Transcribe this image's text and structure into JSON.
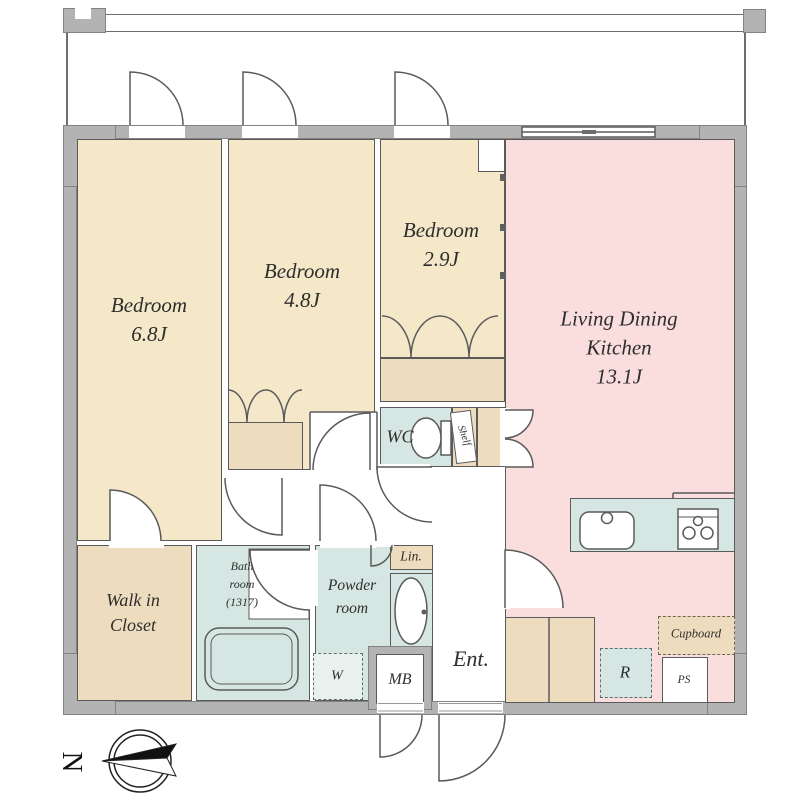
{
  "plan": {
    "bedroom1": {
      "name": "Bedroom",
      "area": "6.8J"
    },
    "bedroom2": {
      "name": "Bedroom",
      "area": "4.8J"
    },
    "bedroom3": {
      "name": "Bedroom",
      "area": "2.9J"
    },
    "ldk": {
      "name_line1": "Living Dining",
      "name_line2": "Kitchen",
      "area": "13.1J"
    },
    "wic": {
      "name_line1": "Walk in",
      "name_line2": "Closet"
    },
    "bath": {
      "name_line1": "Bath",
      "name_line2": "room",
      "name_line3": "(1317)"
    },
    "powder": {
      "name_line1": "Powder",
      "name_line2": "room"
    },
    "wc": "WC",
    "shelf": "Shelf",
    "lin": "Lin.",
    "ent": "Ent.",
    "washer": "W",
    "meter_box": "MB",
    "refrigerator": "R",
    "pipe_space": "PS",
    "cupboard": "Cupboard",
    "compass_north": "N"
  },
  "colors": {
    "wall": "#b3b3b3",
    "bedroom_fill": "#f4e8c8",
    "closet_fill": "#eedcbe",
    "ldk_fill": "#fadddd",
    "wet_area_fill": "#d6e6e2",
    "line": "#5a5a5a"
  }
}
